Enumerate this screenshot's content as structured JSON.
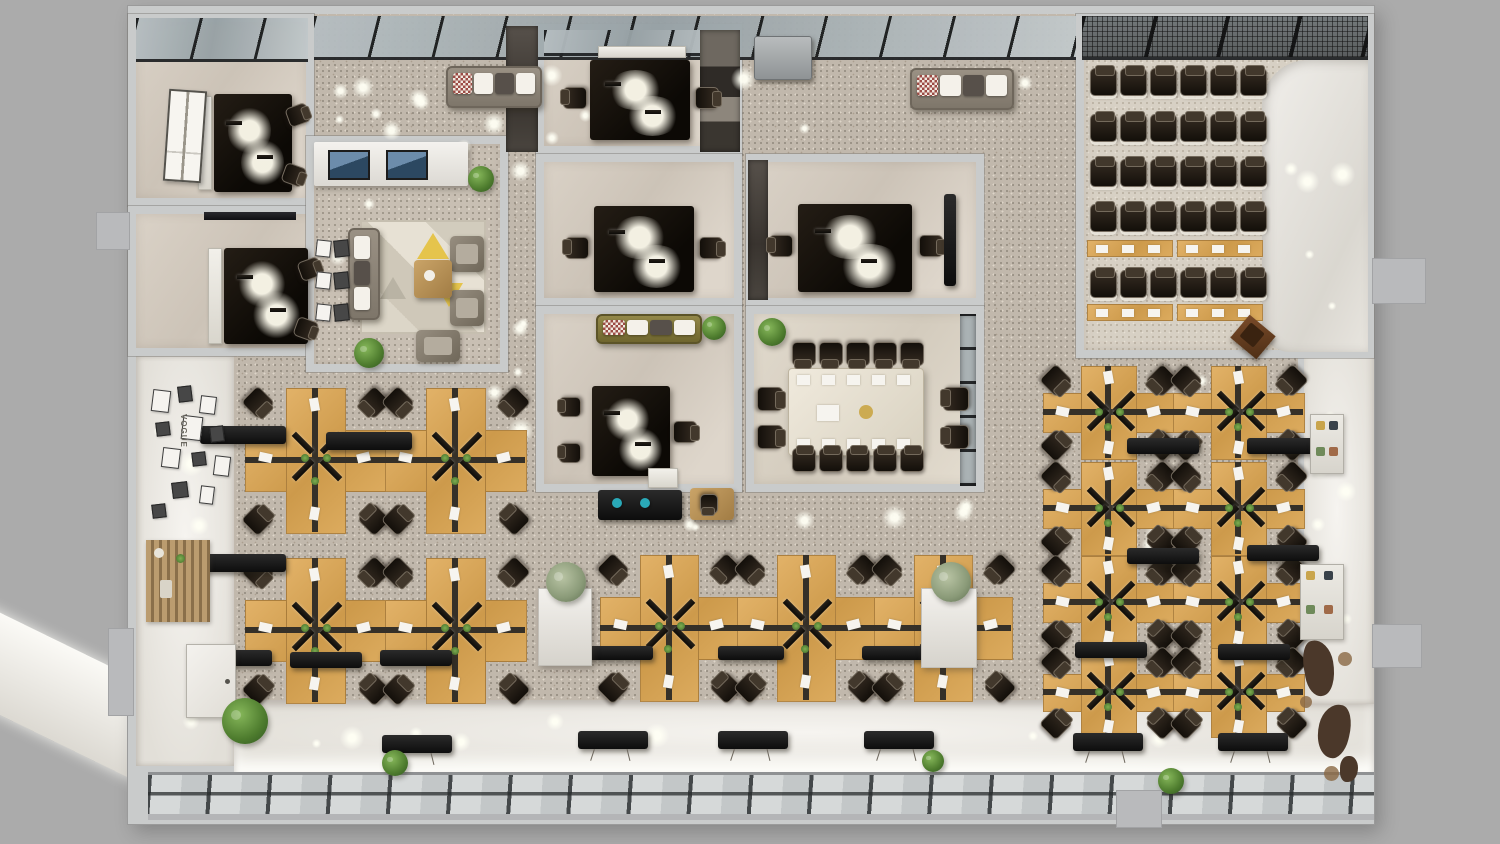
{
  "title": "3D top-down office floor plan render",
  "labels": {
    "gallery": "VOGUE"
  },
  "palette": {
    "outer": "#ababab",
    "wall": "#c9cbcb",
    "carpet": "#c1b8ac",
    "carpet2": "#c8bfb3",
    "wood": "#d8a75c",
    "dark_desk": "#17120d",
    "chair": "#2a2219",
    "cabinet": "#161412",
    "sofa_gray": "#8e8577",
    "sofa_olive": "#867b42",
    "plant": "#4e7c2e",
    "glass": "#a3adb1",
    "mullion": "#1b1d1e",
    "window_glass": "#ccd0d0",
    "accent_teal": "#2aa9b8",
    "map_decal": "#4b382a",
    "paper": "#f6f4ef"
  },
  "rooms_summary": {
    "private_offices": 2,
    "meeting_rooms": 3,
    "manager_office": 1,
    "conference_room_seats": 14,
    "training_room_chair_rows": 5,
    "training_chairs_per_row": 6,
    "training_tables": 4,
    "workstation_clusters_left": 4,
    "workstation_clusters_center": 3,
    "workstation_clusters_right": 8
  },
  "objects": [
    {
      "t": "ramp",
      "x": -80,
      "y": 652,
      "w": 300,
      "h": 92,
      "r": 26
    },
    {
      "t": "base",
      "x": 128,
      "y": 6,
      "w": 1246,
      "h": 818
    },
    {
      "t": "carpet",
      "x": 230,
      "y": 14,
      "w": 1076,
      "h": 726
    },
    {
      "t": "white",
      "x": 136,
      "y": 356,
      "w": 98,
      "h": 410,
      "v": "corridor"
    },
    {
      "t": "white",
      "x": 234,
      "y": 700,
      "w": 1140,
      "h": 72,
      "v": "ledge"
    },
    {
      "t": "white",
      "x": 1300,
      "y": 352,
      "w": 74,
      "h": 352,
      "v": "corridor"
    },
    {
      "t": "wall",
      "x": 1298,
      "y": 352,
      "w": 6,
      "h": 352
    },
    {
      "t": "winband",
      "x": 148,
      "y": 772,
      "w": 1226,
      "h": 48
    },
    {
      "t": "room",
      "id": "private-office-1",
      "x": 128,
      "y": 14,
      "w": 186,
      "h": 192,
      "f": "room"
    },
    {
      "t": "room",
      "id": "private-office-2",
      "x": 128,
      "y": 206,
      "w": 234,
      "h": 150,
      "f": "room"
    },
    {
      "t": "room",
      "id": "lounge-reception",
      "x": 306,
      "y": 136,
      "w": 202,
      "h": 236,
      "f": "carpet2"
    },
    {
      "t": "room",
      "id": "meeting-room-1",
      "x": 536,
      "y": 24,
      "w": 206,
      "h": 130,
      "f": "room"
    },
    {
      "t": "room",
      "id": "meeting-room-2",
      "x": 536,
      "y": 154,
      "w": 206,
      "h": 152,
      "f": "room"
    },
    {
      "t": "room",
      "id": "manager-office",
      "x": 536,
      "y": 306,
      "w": 206,
      "h": 186,
      "f": "room"
    },
    {
      "t": "room",
      "id": "meeting-room-3",
      "x": 746,
      "y": 154,
      "w": 238,
      "h": 152,
      "f": "room"
    },
    {
      "t": "room",
      "id": "conference-room",
      "x": 746,
      "y": 306,
      "w": 238,
      "h": 186,
      "f": "room2"
    },
    {
      "t": "room",
      "id": "training-room",
      "x": 1076,
      "y": 14,
      "w": 298,
      "h": 344,
      "f": "training"
    },
    {
      "t": "white",
      "x": 1262,
      "y": 60,
      "w": 106,
      "h": 292,
      "v": "curve"
    },
    {
      "t": "sky",
      "x": 136,
      "y": 18,
      "w": 172,
      "h": 44
    },
    {
      "t": "sky",
      "x": 314,
      "y": 16,
      "w": 762,
      "h": 44
    },
    {
      "t": "sky",
      "x": 544,
      "y": 30,
      "w": 190,
      "h": 26
    },
    {
      "t": "sky",
      "x": 1082,
      "y": 16,
      "w": 286,
      "h": 44,
      "v": "mesh"
    },
    {
      "t": "dstrip",
      "x": 506,
      "y": 26,
      "w": 32,
      "h": 126
    },
    {
      "t": "dstrip",
      "x": 700,
      "y": 30,
      "w": 40,
      "h": 122,
      "v": "mix"
    },
    {
      "t": "dstrip",
      "x": 748,
      "y": 160,
      "w": 20,
      "h": 140
    },
    {
      "t": "dstrip",
      "x": 960,
      "y": 314,
      "w": 16,
      "h": 172,
      "v": "glass"
    },
    {
      "t": "glows",
      "x": 318,
      "y": 60,
      "w": 750,
      "h": 96,
      "n": 16,
      "seed": 7
    },
    {
      "t": "glows",
      "x": 508,
      "y": 158,
      "w": 26,
      "h": 330,
      "n": 5,
      "seed": 11
    },
    {
      "t": "glows",
      "x": 540,
      "y": 486,
      "w": 470,
      "h": 62,
      "n": 8,
      "seed": 13
    },
    {
      "t": "glows",
      "x": 238,
      "y": 364,
      "w": 300,
      "h": 330,
      "n": 9,
      "seed": 17
    },
    {
      "t": "glows",
      "x": 1012,
      "y": 360,
      "w": 288,
      "h": 368,
      "n": 10,
      "seed": 19
    },
    {
      "t": "glows",
      "x": 1306,
      "y": 364,
      "w": 58,
      "h": 330,
      "n": 6,
      "seed": 23
    },
    {
      "t": "glows",
      "x": 1272,
      "y": 80,
      "w": 86,
      "h": 260,
      "n": 5,
      "seed": 29
    },
    {
      "t": "glows",
      "x": 140,
      "y": 364,
      "w": 86,
      "h": 380,
      "n": 5,
      "seed": 31
    },
    {
      "t": "glows",
      "x": 320,
      "y": 176,
      "w": 178,
      "h": 186,
      "n": 5,
      "seed": 37
    },
    {
      "t": "glows",
      "x": 244,
      "y": 704,
      "w": 1110,
      "h": 50,
      "n": 9,
      "seed": 41
    },
    {
      "t": "cred",
      "x": 198,
      "y": 96,
      "w": 14,
      "h": 94
    },
    {
      "t": "ddesk",
      "x": 214,
      "y": 94,
      "w": 78,
      "h": 98
    },
    {
      "t": "chair",
      "x": 288,
      "y": 104,
      "w": 20,
      "h": 22,
      "r": 70
    },
    {
      "t": "chair",
      "x": 284,
      "y": 164,
      "w": 20,
      "h": 22,
      "r": 110
    },
    {
      "t": "wframe",
      "x": 166,
      "y": 90,
      "w": 38,
      "h": 92,
      "r": 4
    },
    {
      "t": "tv",
      "x": 204,
      "y": 212,
      "w": 92,
      "h": 8
    },
    {
      "t": "cred",
      "x": 208,
      "y": 248,
      "w": 14,
      "h": 96
    },
    {
      "t": "ddesk",
      "x": 224,
      "y": 248,
      "w": 84,
      "h": 96
    },
    {
      "t": "chair",
      "x": 300,
      "y": 258,
      "w": 20,
      "h": 22,
      "r": 70
    },
    {
      "t": "chair",
      "x": 296,
      "y": 318,
      "w": 20,
      "h": 22,
      "r": 110
    },
    {
      "t": "recdesk",
      "x": 314,
      "y": 142,
      "w": 154,
      "h": 44
    },
    {
      "t": "rug",
      "x": 362,
      "y": 222,
      "w": 122,
      "h": 110
    },
    {
      "t": "sofa",
      "x": 348,
      "y": 228,
      "w": 32,
      "h": 92,
      "v": "gray",
      "dir": "v"
    },
    {
      "t": "arm",
      "x": 450,
      "y": 236,
      "w": 34,
      "h": 36
    },
    {
      "t": "arm",
      "x": 450,
      "y": 290,
      "w": 34,
      "h": 36
    },
    {
      "t": "ctable",
      "x": 414,
      "y": 260,
      "w": 38,
      "h": 38
    },
    {
      "t": "arm",
      "x": 416,
      "y": 330,
      "w": 44,
      "h": 32
    },
    {
      "t": "plant",
      "x": 468,
      "y": 166,
      "d": 26
    },
    {
      "t": "plant",
      "x": 354,
      "y": 338,
      "d": 30
    },
    {
      "t": "gallery2",
      "x": 316,
      "y": 240,
      "w": 36,
      "h": 98
    },
    {
      "t": "cred",
      "x": 598,
      "y": 46,
      "w": 88,
      "h": 12
    },
    {
      "t": "ddesk",
      "x": 590,
      "y": 60,
      "w": 100,
      "h": 80
    },
    {
      "t": "chair",
      "x": 564,
      "y": 86,
      "w": 22,
      "h": 24,
      "r": -90
    },
    {
      "t": "chair",
      "x": 696,
      "y": 86,
      "w": 22,
      "h": 24,
      "r": 90
    },
    {
      "t": "ddesk",
      "x": 594,
      "y": 206,
      "w": 100,
      "h": 86
    },
    {
      "t": "chair",
      "x": 566,
      "y": 236,
      "w": 22,
      "h": 24,
      "r": -90
    },
    {
      "t": "chair",
      "x": 700,
      "y": 236,
      "w": 22,
      "h": 24,
      "r": 90
    },
    {
      "t": "sofa",
      "x": 596,
      "y": 314,
      "w": 106,
      "h": 30,
      "v": "olive"
    },
    {
      "t": "plant",
      "x": 702,
      "y": 316,
      "d": 24
    },
    {
      "t": "ddesk",
      "x": 592,
      "y": 386,
      "w": 78,
      "h": 90
    },
    {
      "t": "chair",
      "x": 674,
      "y": 420,
      "w": 22,
      "h": 24,
      "r": 90
    },
    {
      "t": "chair",
      "x": 560,
      "y": 396,
      "w": 20,
      "h": 22,
      "r": -90
    },
    {
      "t": "chair",
      "x": 560,
      "y": 442,
      "w": 20,
      "h": 22,
      "r": -90
    },
    {
      "t": "cred",
      "x": 648,
      "y": 468,
      "w": 30,
      "h": 20
    },
    {
      "t": "ddesk",
      "x": 798,
      "y": 204,
      "w": 114,
      "h": 88
    },
    {
      "t": "chair",
      "x": 770,
      "y": 234,
      "w": 22,
      "h": 24,
      "r": -90
    },
    {
      "t": "chair",
      "x": 920,
      "y": 234,
      "w": 22,
      "h": 24,
      "r": 90
    },
    {
      "t": "cab",
      "x": 944,
      "y": 194,
      "w": 12,
      "h": 92
    },
    {
      "t": "plant",
      "x": 758,
      "y": 318,
      "d": 28
    },
    {
      "t": "confset",
      "x": 754,
      "y": 330,
      "w": 216,
      "h": 152
    },
    {
      "t": "trow",
      "x": 1090,
      "y": 68,
      "n": 6,
      "gap": 30
    },
    {
      "t": "trow",
      "x": 1090,
      "y": 114,
      "n": 6,
      "gap": 30
    },
    {
      "t": "trow",
      "x": 1090,
      "y": 159,
      "n": 6,
      "gap": 30
    },
    {
      "t": "trow",
      "x": 1090,
      "y": 204,
      "n": 6,
      "gap": 30
    },
    {
      "t": "ttable",
      "x": 1087,
      "y": 240,
      "w": 86,
      "h": 17
    },
    {
      "t": "ttable",
      "x": 1177,
      "y": 240,
      "w": 86,
      "h": 17
    },
    {
      "t": "trow",
      "x": 1090,
      "y": 270,
      "n": 6,
      "gap": 30
    },
    {
      "t": "ttable",
      "x": 1087,
      "y": 304,
      "w": 86,
      "h": 17
    },
    {
      "t": "ttable",
      "x": 1177,
      "y": 304,
      "w": 86,
      "h": 17
    },
    {
      "t": "podium",
      "x": 1236,
      "y": 322,
      "w": 34,
      "h": 30,
      "r": 40
    },
    {
      "t": "sofa",
      "x": 446,
      "y": 66,
      "w": 96,
      "h": 42,
      "v": "gray"
    },
    {
      "t": "sofa",
      "x": 910,
      "y": 68,
      "w": 104,
      "h": 42,
      "v": "gray"
    },
    {
      "t": "cab",
      "x": 754,
      "y": 36,
      "w": 58,
      "h": 44,
      "v": "gray"
    },
    {
      "t": "cab",
      "x": 598,
      "y": 490,
      "w": 84,
      "h": 30
    },
    {
      "t": "dot",
      "x": 612,
      "y": 498,
      "d": 10,
      "c": "#2aa9b8"
    },
    {
      "t": "dot",
      "x": 640,
      "y": 498,
      "d": 10,
      "c": "#2aa9b8"
    },
    {
      "t": "ctable",
      "x": 690,
      "y": 488,
      "w": 44,
      "h": 32
    },
    {
      "t": "chair",
      "x": 700,
      "y": 494,
      "w": 18,
      "h": 20,
      "r": 180
    },
    {
      "t": "cluster",
      "x": 245,
      "y": 388,
      "w": 140,
      "h": 144
    },
    {
      "t": "cluster",
      "x": 385,
      "y": 388,
      "w": 140,
      "h": 144
    },
    {
      "t": "cluster",
      "x": 245,
      "y": 558,
      "w": 140,
      "h": 144
    },
    {
      "t": "cluster",
      "x": 385,
      "y": 558,
      "w": 140,
      "h": 144
    },
    {
      "t": "cluster",
      "x": 600,
      "y": 555,
      "w": 137,
      "h": 145
    },
    {
      "t": "cluster",
      "x": 737,
      "y": 555,
      "w": 137,
      "h": 145
    },
    {
      "t": "cluster",
      "x": 874,
      "y": 555,
      "w": 137,
      "h": 145
    },
    {
      "t": "cluster",
      "x": 1043,
      "y": 366,
      "w": 130,
      "h": 92
    },
    {
      "t": "cluster",
      "x": 1173,
      "y": 366,
      "w": 130,
      "h": 92
    },
    {
      "t": "cluster",
      "x": 1043,
      "y": 462,
      "w": 130,
      "h": 92
    },
    {
      "t": "cluster",
      "x": 1173,
      "y": 462,
      "w": 130,
      "h": 92
    },
    {
      "t": "cluster",
      "x": 1043,
      "y": 556,
      "w": 130,
      "h": 92
    },
    {
      "t": "cluster",
      "x": 1173,
      "y": 556,
      "w": 130,
      "h": 92
    },
    {
      "t": "cluster",
      "x": 1043,
      "y": 648,
      "w": 130,
      "h": 88
    },
    {
      "t": "cluster",
      "x": 1173,
      "y": 648,
      "w": 130,
      "h": 88
    },
    {
      "t": "cab",
      "x": 200,
      "y": 426,
      "w": 86,
      "h": 18
    },
    {
      "t": "cab",
      "x": 326,
      "y": 432,
      "w": 86,
      "h": 18
    },
    {
      "t": "cab",
      "x": 200,
      "y": 554,
      "w": 86,
      "h": 18
    },
    {
      "t": "cab",
      "x": 200,
      "y": 650,
      "w": 72,
      "h": 16
    },
    {
      "t": "cab",
      "x": 290,
      "y": 652,
      "w": 72,
      "h": 16
    },
    {
      "t": "cab",
      "x": 380,
      "y": 650,
      "w": 72,
      "h": 16
    },
    {
      "t": "cab",
      "x": 587,
      "y": 646,
      "w": 66,
      "h": 14
    },
    {
      "t": "cab",
      "x": 718,
      "y": 646,
      "w": 66,
      "h": 14
    },
    {
      "t": "cab",
      "x": 862,
      "y": 646,
      "w": 66,
      "h": 14
    },
    {
      "t": "cab",
      "x": 1127,
      "y": 438,
      "w": 72,
      "h": 16
    },
    {
      "t": "cab",
      "x": 1247,
      "y": 438,
      "w": 72,
      "h": 16
    },
    {
      "t": "cab",
      "x": 1127,
      "y": 548,
      "w": 72,
      "h": 16
    },
    {
      "t": "cab",
      "x": 1247,
      "y": 545,
      "w": 72,
      "h": 16
    },
    {
      "t": "cab",
      "x": 1075,
      "y": 642,
      "w": 72,
      "h": 16
    },
    {
      "t": "cab",
      "x": 1218,
      "y": 644,
      "w": 72,
      "h": 16
    },
    {
      "t": "cab",
      "x": 382,
      "y": 735,
      "w": 70,
      "h": 18,
      "v": "wire"
    },
    {
      "t": "cab",
      "x": 578,
      "y": 731,
      "w": 70,
      "h": 18,
      "v": "wire"
    },
    {
      "t": "cab",
      "x": 718,
      "y": 731,
      "w": 70,
      "h": 18,
      "v": "wire"
    },
    {
      "t": "cab",
      "x": 864,
      "y": 731,
      "w": 70,
      "h": 18,
      "v": "wire"
    },
    {
      "t": "cab",
      "x": 1073,
      "y": 733,
      "w": 70,
      "h": 18,
      "v": "wire"
    },
    {
      "t": "cab",
      "x": 1218,
      "y": 733,
      "w": 70,
      "h": 18,
      "v": "wire"
    },
    {
      "t": "planter",
      "x": 538,
      "y": 588,
      "w": 54,
      "h": 78
    },
    {
      "t": "plant",
      "x": 546,
      "y": 562,
      "d": 40,
      "v": "pale"
    },
    {
      "t": "planter",
      "x": 921,
      "y": 588,
      "w": 56,
      "h": 80
    },
    {
      "t": "plant",
      "x": 931,
      "y": 562,
      "d": 40,
      "v": "pale"
    },
    {
      "t": "shelf",
      "x": 1310,
      "y": 414,
      "w": 34,
      "h": 60
    },
    {
      "t": "shelf",
      "x": 1300,
      "y": 564,
      "w": 44,
      "h": 76
    },
    {
      "t": "map",
      "x": 1296,
      "y": 634,
      "w": 66,
      "h": 152
    },
    {
      "t": "gallery",
      "x": 148,
      "y": 386,
      "w": 90,
      "h": 140
    },
    {
      "t": "console",
      "x": 146,
      "y": 540,
      "w": 64,
      "h": 82
    },
    {
      "t": "door",
      "x": 186,
      "y": 644,
      "w": 50,
      "h": 74
    },
    {
      "t": "plant",
      "x": 222,
      "y": 698,
      "d": 46
    },
    {
      "t": "plant",
      "x": 382,
      "y": 750,
      "d": 26
    },
    {
      "t": "plant",
      "x": 922,
      "y": 750,
      "d": 22
    },
    {
      "t": "plant",
      "x": 1158,
      "y": 768,
      "d": 26
    },
    {
      "t": "tab",
      "x": 96,
      "y": 212,
      "w": 34,
      "h": 38
    },
    {
      "t": "tab",
      "x": 108,
      "y": 628,
      "w": 26,
      "h": 88
    },
    {
      "t": "tab",
      "x": 1372,
      "y": 258,
      "w": 54,
      "h": 46
    },
    {
      "t": "tab",
      "x": 1372,
      "y": 624,
      "w": 50,
      "h": 44
    },
    {
      "t": "tab",
      "x": 1116,
      "y": 790,
      "w": 46,
      "h": 38
    }
  ]
}
